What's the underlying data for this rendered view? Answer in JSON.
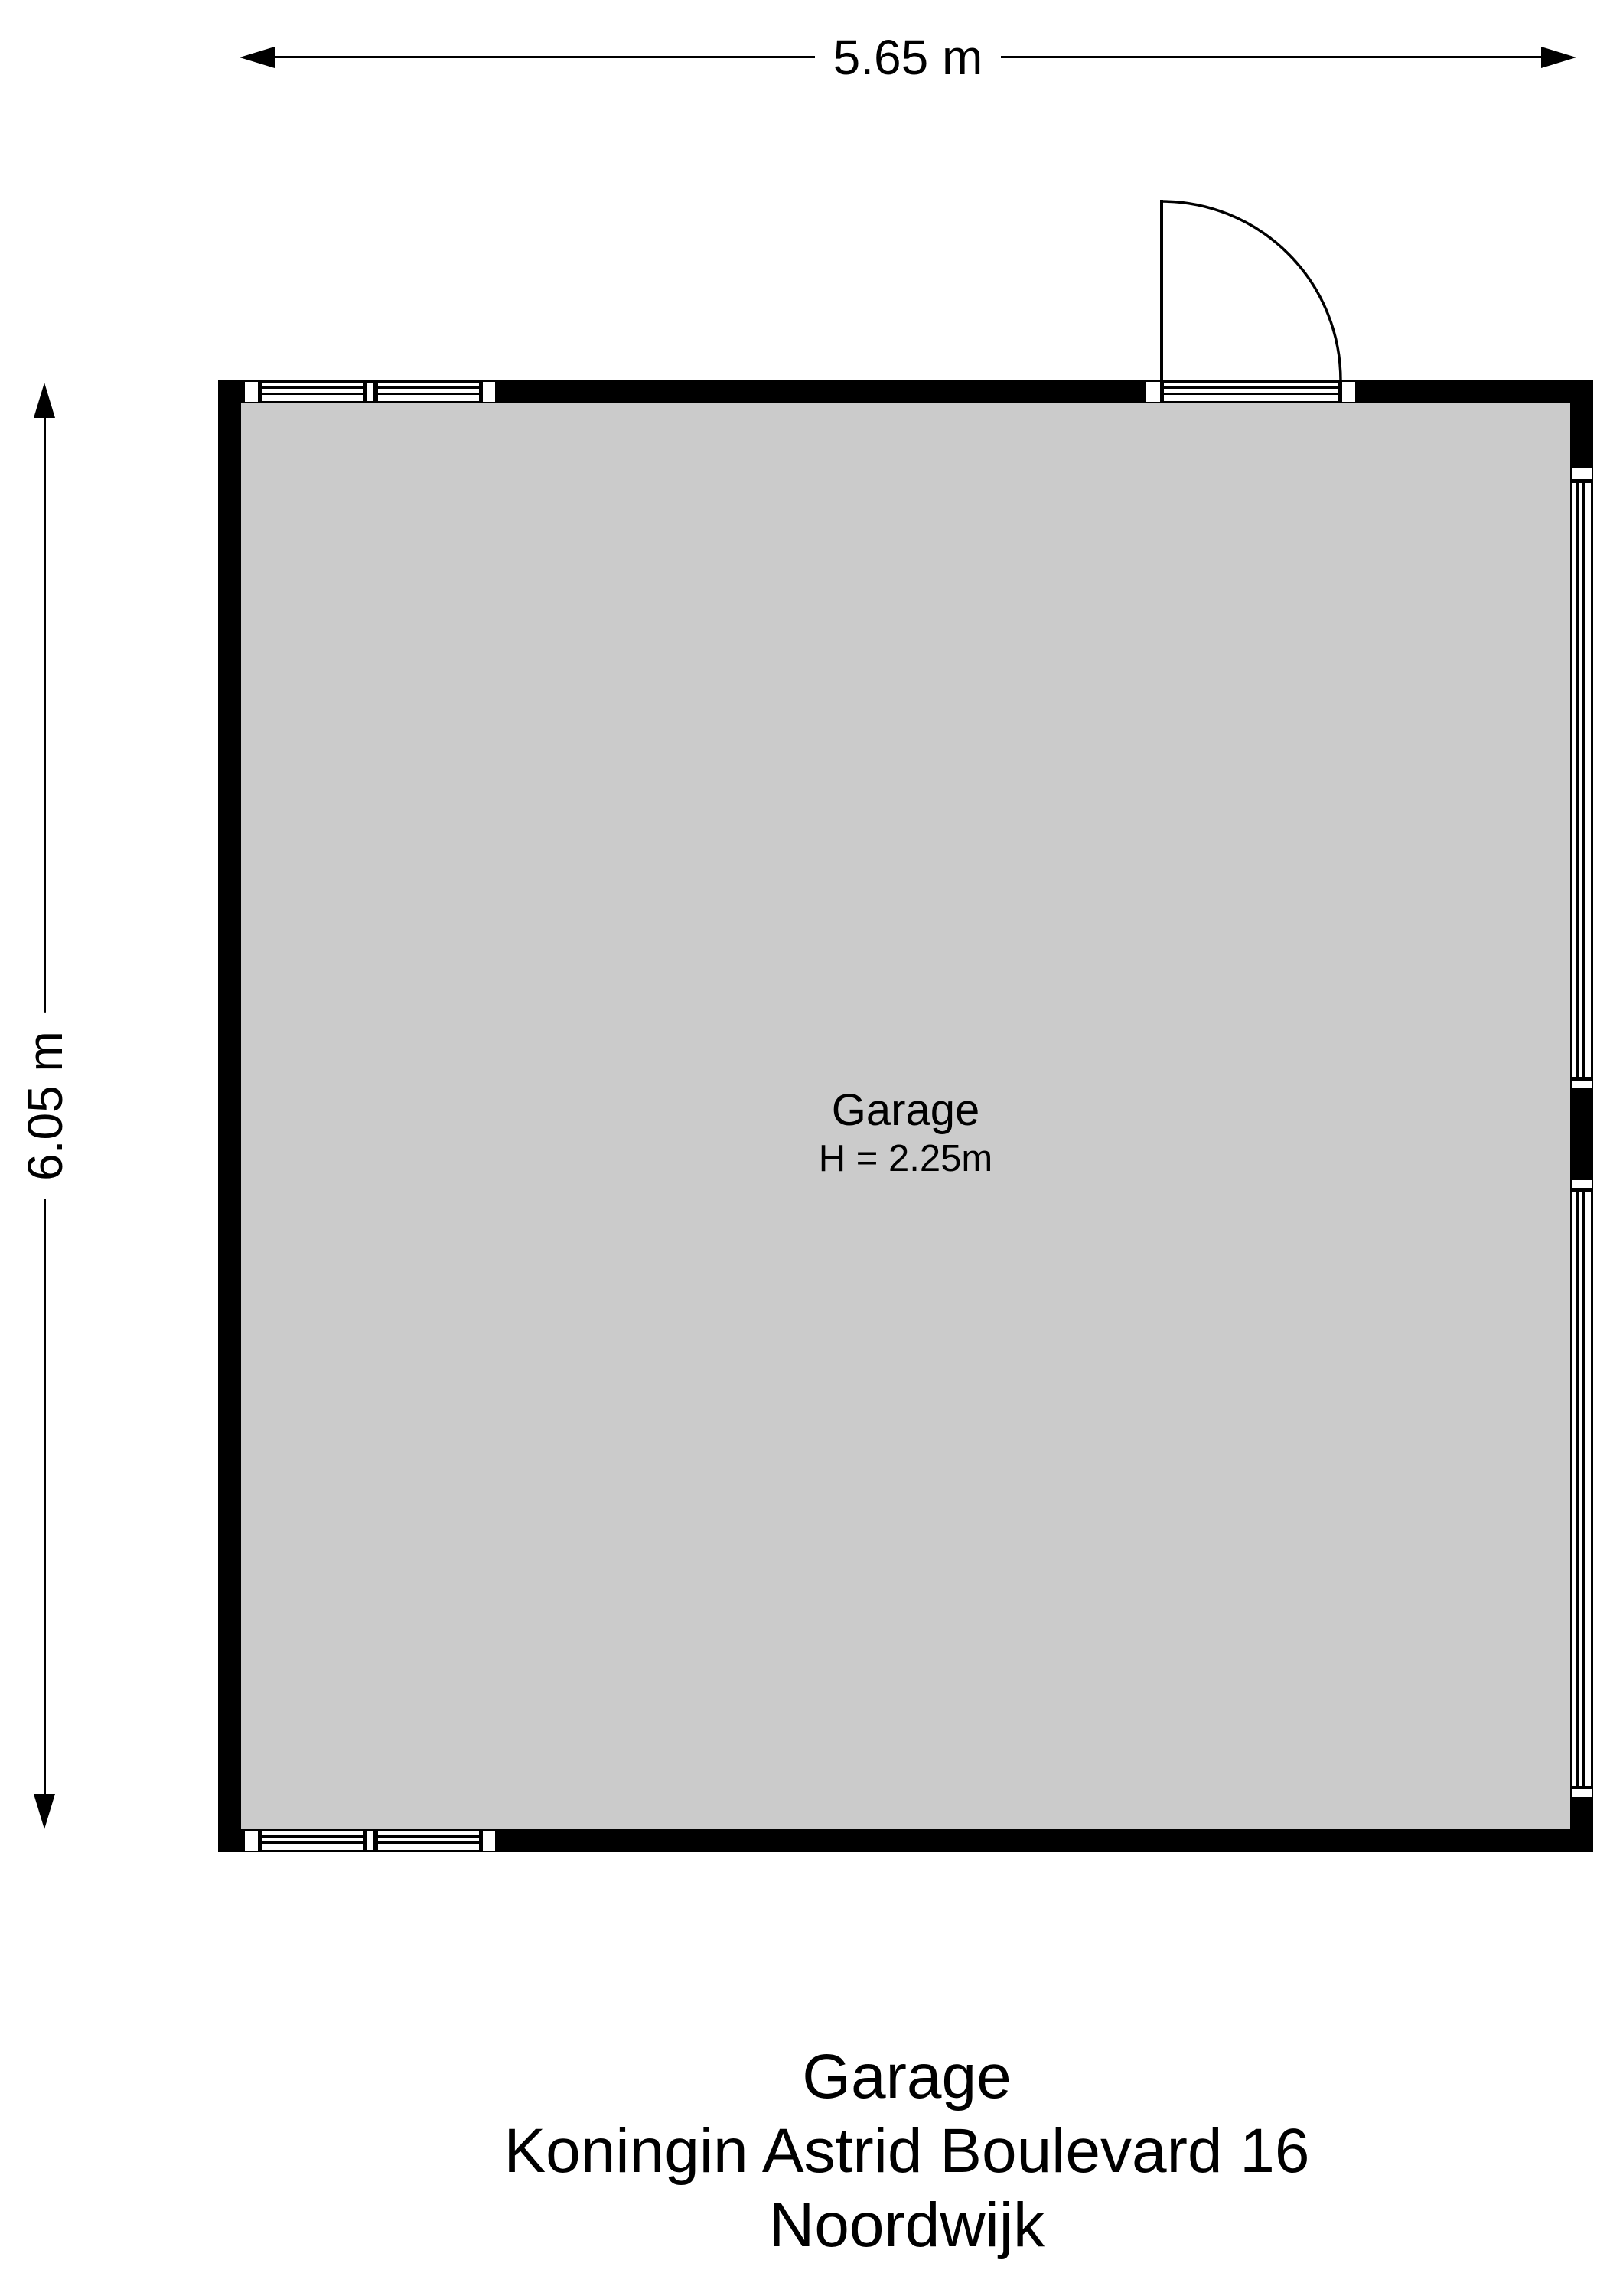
{
  "dimensions": {
    "width": "5.65 m",
    "height": "6.05 m"
  },
  "plan": {
    "room_label": "Garage",
    "room_height": "H = 2.25m"
  },
  "title": {
    "line1": "Garage",
    "line2": "Koningin Astrid Boulevard 16",
    "line3": "Noordwijk"
  },
  "icons": {
    "dim_arrow": "solid-triangle",
    "door_swing": "quarter-circle-arc"
  },
  "colors": {
    "wall": "#000000",
    "floor": "#cbcbcb",
    "background": "#ffffff",
    "ink": "#000000"
  }
}
